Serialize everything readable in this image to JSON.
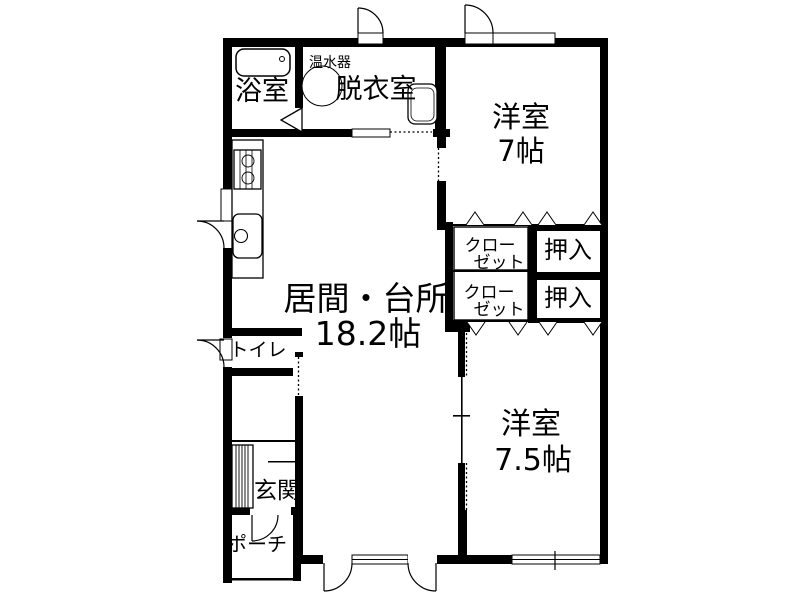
{
  "colors": {
    "wall": "#000000",
    "background": "#ffffff",
    "line": "#000000"
  },
  "labels": [
    {
      "id": "bathroom",
      "text": "浴室",
      "x": 262,
      "y": 100,
      "size": 27
    },
    {
      "id": "water-heater",
      "text": "温水器",
      "x": 330,
      "y": 67,
      "size": 14
    },
    {
      "id": "dressing-room",
      "text": "脱衣室",
      "x": 376,
      "y": 98,
      "size": 27
    },
    {
      "id": "bedroom7-name",
      "text": "洋室",
      "x": 521,
      "y": 127,
      "size": 29
    },
    {
      "id": "bedroom7-size",
      "text": "7帖",
      "x": 521,
      "y": 161,
      "size": 29
    },
    {
      "id": "closet1-line1",
      "text": "クロー",
      "x": 490,
      "y": 251,
      "size": 17
    },
    {
      "id": "closet1-line2",
      "text": "ゼット",
      "x": 499,
      "y": 268,
      "size": 17
    },
    {
      "id": "oshiire1",
      "text": "押入",
      "x": 568,
      "y": 258,
      "size": 24
    },
    {
      "id": "closet2-line1",
      "text": "クロー",
      "x": 489,
      "y": 298,
      "size": 17
    },
    {
      "id": "closet2-line2",
      "text": "ゼット",
      "x": 499,
      "y": 315,
      "size": 17
    },
    {
      "id": "oshiire2",
      "text": "押入",
      "x": 568,
      "y": 306,
      "size": 24
    },
    {
      "id": "living-name",
      "text": "居間・台所",
      "x": 366,
      "y": 310,
      "size": 33
    },
    {
      "id": "living-size",
      "text": "18.2帖",
      "x": 368,
      "y": 345,
      "size": 33
    },
    {
      "id": "toilet",
      "text": "トイレ",
      "x": 258,
      "y": 356,
      "size": 19
    },
    {
      "id": "genkan",
      "text": "玄関",
      "x": 277,
      "y": 498,
      "size": 23
    },
    {
      "id": "porch",
      "text": "ポーチ",
      "x": 257,
      "y": 551,
      "size": 20
    },
    {
      "id": "bedroom75-name",
      "text": "洋室",
      "x": 531,
      "y": 434,
      "size": 30
    },
    {
      "id": "bedroom75-size",
      "text": "7.5帖",
      "x": 533,
      "y": 470,
      "size": 30
    }
  ],
  "fixtures": [
    "bathtub",
    "water-heater-tank",
    "washing-machine",
    "gas-stove",
    "kitchen-sink",
    "shoe-cabinet",
    "bathroom-folding-door",
    "swing-doors",
    "sliding-doors",
    "windows",
    "closet-door-markers"
  ]
}
